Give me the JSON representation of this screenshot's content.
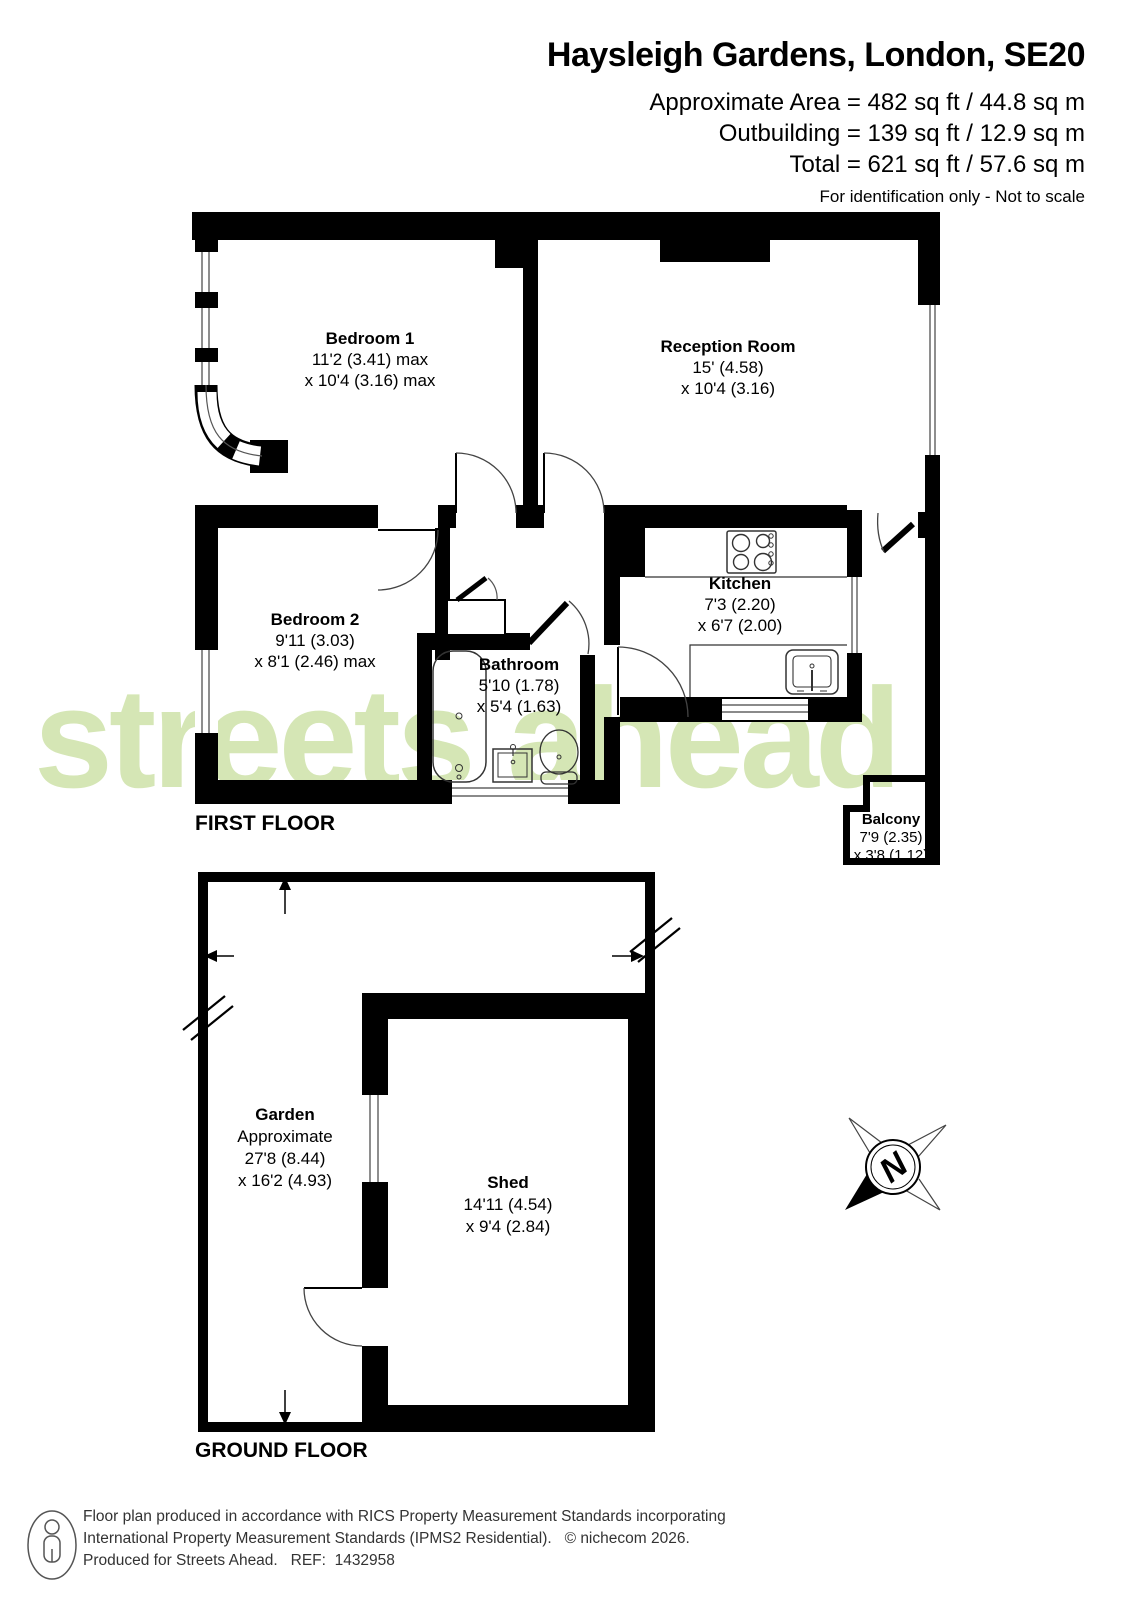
{
  "header": {
    "title": "Haysleigh Gardens, London, SE20",
    "area_line": "Approximate Area = 482 sq ft / 44.8 sq m",
    "outbuilding_line": "Outbuilding = 139 sq ft / 12.9 sq m",
    "total_line": "Total = 621 sq ft / 57.6 sq m",
    "disclaimer": "For identification only - Not to scale"
  },
  "watermark_text": "streets ahead",
  "first_floor": {
    "label": "FIRST FLOOR",
    "rooms": {
      "bedroom1": {
        "name": "Bedroom 1",
        "dim1": "11'2 (3.41) max",
        "dim2": "x 10'4 (3.16) max"
      },
      "reception": {
        "name": "Reception Room",
        "dim1": "15' (4.58)",
        "dim2": "x 10'4 (3.16)"
      },
      "bedroom2": {
        "name": "Bedroom 2",
        "dim1": "9'11 (3.03)",
        "dim2": "x 8'1 (2.46) max"
      },
      "kitchen": {
        "name": "Kitchen",
        "dim1": "7'3 (2.20)",
        "dim2": "x 6'7 (2.00)"
      },
      "bathroom": {
        "name": "Bathroom",
        "dim1": "5'10 (1.78)",
        "dim2": "x 5'4 (1.63)"
      },
      "balcony": {
        "name": "Balcony",
        "dim1": "7'9 (2.35)",
        "dim2": "x 3'8 (1.12)"
      }
    }
  },
  "ground_floor": {
    "label": "GROUND FLOOR",
    "rooms": {
      "garden": {
        "name": "Garden",
        "note": "Approximate",
        "dim1": "27'8 (8.44)",
        "dim2": "x 16'2 (4.93)"
      },
      "shed": {
        "name": "Shed",
        "dim1": "14'11 (4.54)",
        "dim2": "x 9'4 (2.84)"
      }
    }
  },
  "compass": {
    "label": "N"
  },
  "footer": {
    "line1": "Floor plan produced in accordance with RICS Property Measurement Standards incorporating",
    "line2": "International Property Measurement Standards (IPMS2 Residential).   © nichecom 2026.",
    "line3": "Produced for Streets Ahead.   REF:  1432958"
  },
  "colors": {
    "wall": "#000000",
    "watermark": "#d5e6b5"
  }
}
